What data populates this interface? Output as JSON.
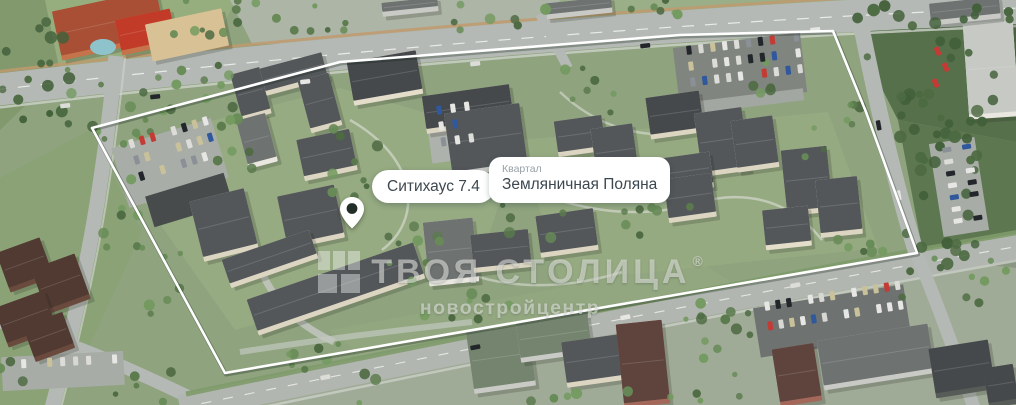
{
  "view": {
    "width": 1016,
    "height": 405,
    "description": "Aerial 3D render of a residential quarter with white plot boundary outline"
  },
  "labels": {
    "project": {
      "text": "Ситихаус 7.4"
    },
    "quarter": {
      "kicker": "Квартал",
      "title": "Земляничная Поляна"
    }
  },
  "watermark": {
    "brand": "ТВОЯ СТОЛИЦА",
    "registered_mark": "®",
    "tagline": "новостройцентр",
    "logo_icon": "brand-grid-icon"
  },
  "icons": {
    "pin": "location-pin-icon"
  },
  "colors": {
    "boundary": "#ffffff",
    "label_bg": "#ffffff",
    "label_text": "#3d474f",
    "label_kicker": "#98a1a7",
    "pin_body": "#ffffff",
    "pin_dot": "#232e29",
    "watermark": "rgba(236,237,233,0.55)"
  }
}
